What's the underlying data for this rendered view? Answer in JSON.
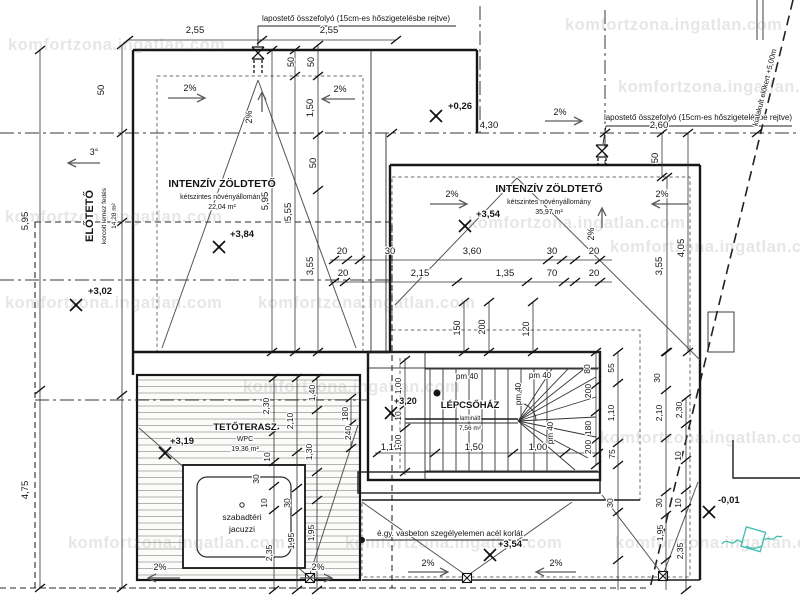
{
  "watermark": {
    "text": "komfortzona.ingatlan.com"
  },
  "icons": {
    "logo": "komfortzona-signature-logo",
    "elevation_marker": "x-cross-benchmark",
    "roof_drain": "funnel-hourglass",
    "floor_drain": "square-with-diagonals"
  },
  "colors": {
    "line": "#1c1c1c",
    "paper": "#ffffff",
    "plants": "#8f8f8f",
    "logo_teal": "#3fbdb0"
  },
  "labels": [
    {
      "n": "note-flat-roof-drain-top",
      "t": "lapostető összefolyó (15cm-es hőszigetelésbe rejtve)",
      "x": 356,
      "y": 21,
      "s": 8,
      "a": "m"
    },
    {
      "n": "note-flat-roof-drain-right",
      "t": "lapostető összefolyó (15cm-es hőszigetelésbe rejtve)",
      "x": 698,
      "y": 120,
      "s": 8,
      "a": "m"
    },
    {
      "n": "note-boundary-setback",
      "t": "kialakult előkert +5,00m",
      "x": 767,
      "y": 88,
      "s": 7.5,
      "a": "m",
      "r": -76
    },
    {
      "n": "note-steel-railing",
      "t": "é.gy. vasbeton szegélyelemen acél korlát",
      "x": 450,
      "y": 536,
      "s": 8,
      "a": "m"
    },
    {
      "n": "room-eloteto-name",
      "t": "ELŐTETŐ",
      "x": 93,
      "y": 216,
      "s": 11,
      "w": 1,
      "a": "m",
      "r": -90
    },
    {
      "n": "room-eloteto-material",
      "t": "korcolt lemez fedés",
      "x": 106,
      "y": 216,
      "s": 6.5,
      "a": "m",
      "r": -90
    },
    {
      "n": "room-eloteto-area",
      "t": "14,28 m²",
      "x": 116,
      "y": 216,
      "s": 6.5,
      "a": "m",
      "r": -90
    },
    {
      "n": "elevation-eloteto",
      "t": "+3,02",
      "x": 88,
      "y": 294,
      "s": 9.5,
      "w": 1,
      "a": "s"
    },
    {
      "n": "room-greenroof-left-name",
      "t": "INTENZÍV ZÖLDTETŐ",
      "x": 222,
      "y": 187,
      "s": 10.5,
      "w": 1,
      "a": "m"
    },
    {
      "n": "room-greenroof-left-material",
      "t": "kétszintes növényállomány",
      "x": 222,
      "y": 199,
      "s": 7,
      "a": "m"
    },
    {
      "n": "room-greenroof-left-area",
      "t": "22,04 m²",
      "x": 222,
      "y": 209,
      "s": 7,
      "a": "m"
    },
    {
      "n": "elevation-greenroof-left",
      "t": "+3,84",
      "x": 230,
      "y": 237,
      "s": 9.5,
      "w": 1,
      "a": "s"
    },
    {
      "n": "room-greenroof-right-name",
      "t": "INTENZÍV ZÖLDTETŐ",
      "x": 549,
      "y": 192,
      "s": 10.5,
      "w": 1,
      "a": "m"
    },
    {
      "n": "room-greenroof-right-material",
      "t": "kétszintes növényállomány",
      "x": 549,
      "y": 204,
      "s": 7,
      "a": "m"
    },
    {
      "n": "room-greenroof-right-area",
      "t": "35,97 m²",
      "x": 549,
      "y": 214,
      "s": 7,
      "a": "m"
    },
    {
      "n": "elevation-greenroof-right",
      "t": "+3,54",
      "x": 476,
      "y": 217,
      "s": 9.5,
      "w": 1,
      "a": "s"
    },
    {
      "n": "elevation-plus026",
      "t": "+0,26",
      "x": 448,
      "y": 109,
      "s": 9.5,
      "w": 1,
      "a": "s"
    },
    {
      "n": "room-staircase-name",
      "t": "LÉPCSŐHÁZ",
      "x": 470,
      "y": 408,
      "s": 9.5,
      "w": 1,
      "a": "m"
    },
    {
      "n": "room-staircase-material",
      "t": "laminált",
      "x": 470,
      "y": 420,
      "s": 6,
      "a": "m"
    },
    {
      "n": "room-staircase-area",
      "t": "7,56 m²",
      "x": 470,
      "y": 430,
      "s": 6.5,
      "a": "m"
    },
    {
      "n": "elevation-staircase",
      "t": "+3,20",
      "x": 394,
      "y": 404,
      "s": 9,
      "w": 1,
      "a": "s"
    },
    {
      "n": "room-terrace-name",
      "t": "TETŐTERASZ",
      "x": 245,
      "y": 430,
      "s": 9.5,
      "w": 1,
      "a": "m"
    },
    {
      "n": "room-terrace-material",
      "t": "WPC",
      "x": 245,
      "y": 441,
      "s": 7,
      "a": "m"
    },
    {
      "n": "room-terrace-area",
      "t": "19,36 m²",
      "x": 245,
      "y": 451,
      "s": 7,
      "a": "m"
    },
    {
      "n": "elevation-terrace",
      "t": "+3,19",
      "x": 170,
      "y": 444,
      "s": 9.5,
      "w": 1,
      "a": "s"
    },
    {
      "n": "label-jacuzzi-line1",
      "t": "szabadtéri",
      "x": 242,
      "y": 520,
      "s": 8.5,
      "a": "m"
    },
    {
      "n": "label-jacuzzi-line2",
      "t": "jacuzzi",
      "x": 242,
      "y": 532,
      "s": 8.5,
      "a": "m"
    },
    {
      "n": "elevation-greenroof-bottom",
      "t": "+3,54",
      "x": 498,
      "y": 547,
      "s": 9.5,
      "w": 1,
      "a": "s"
    },
    {
      "n": "elevation-minus001",
      "t": "-0,01",
      "x": 718,
      "y": 503,
      "s": 9.5,
      "w": 1,
      "a": "s"
    },
    {
      "n": "slope-left-1",
      "t": "2%",
      "x": 190,
      "y": 91,
      "s": 9,
      "a": "m"
    },
    {
      "n": "slope-left-2",
      "t": "2%",
      "x": 340,
      "y": 92,
      "s": 9,
      "a": "m"
    },
    {
      "n": "slope-left-3",
      "t": "2%",
      "x": 252,
      "y": 117,
      "s": 9,
      "a": "m",
      "r": -90
    },
    {
      "n": "slope-right-1",
      "t": "2%",
      "x": 560,
      "y": 115,
      "s": 9,
      "a": "m"
    },
    {
      "n": "slope-right-2",
      "t": "2%",
      "x": 452,
      "y": 197,
      "s": 9,
      "a": "m"
    },
    {
      "n": "slope-right-3",
      "t": "2%",
      "x": 662,
      "y": 197,
      "s": 9,
      "a": "m"
    },
    {
      "n": "slope-right-4",
      "t": "2%",
      "x": 594,
      "y": 234,
      "s": 9,
      "a": "m",
      "r": -90
    },
    {
      "n": "slope-bottom-1",
      "t": "2%",
      "x": 428,
      "y": 566,
      "s": 9,
      "a": "m"
    },
    {
      "n": "slope-bottom-2",
      "t": "2%",
      "x": 556,
      "y": 566,
      "s": 9,
      "a": "m"
    },
    {
      "n": "slope-terrace-1",
      "t": "2%",
      "x": 160,
      "y": 570,
      "s": 9,
      "a": "m"
    },
    {
      "n": "slope-terrace-2",
      "t": "2%",
      "x": 318,
      "y": 570,
      "s": 9,
      "a": "m"
    },
    {
      "n": "slope-eloteto",
      "t": "3°",
      "x": 94,
      "y": 155,
      "s": 9,
      "a": "m"
    },
    {
      "n": "dim",
      "t": "2,55",
      "x": 195,
      "y": 33,
      "s": 9.5,
      "a": "m"
    },
    {
      "n": "dim",
      "t": "2,55",
      "x": 329,
      "y": 33,
      "s": 9.5,
      "a": "m"
    },
    {
      "n": "dim",
      "t": "4,30",
      "x": 489,
      "y": 128,
      "s": 9.5,
      "a": "m"
    },
    {
      "n": "dim",
      "t": "2,60",
      "x": 659,
      "y": 128,
      "s": 9.5,
      "a": "m"
    },
    {
      "n": "dim",
      "t": "20",
      "x": 342,
      "y": 254,
      "s": 9.5,
      "a": "m"
    },
    {
      "n": "dim",
      "t": "30",
      "x": 390,
      "y": 254,
      "s": 9.5,
      "a": "m"
    },
    {
      "n": "dim",
      "t": "3,60",
      "x": 472,
      "y": 254,
      "s": 9.5,
      "a": "m"
    },
    {
      "n": "dim",
      "t": "30",
      "x": 552,
      "y": 254,
      "s": 9.5,
      "a": "m"
    },
    {
      "n": "dim",
      "t": "20",
      "x": 594,
      "y": 254,
      "s": 9.5,
      "a": "m"
    },
    {
      "n": "dim",
      "t": "20",
      "x": 343,
      "y": 276,
      "s": 9.5,
      "a": "m"
    },
    {
      "n": "dim",
      "t": "2,15",
      "x": 420,
      "y": 276,
      "s": 9.5,
      "a": "m"
    },
    {
      "n": "dim",
      "t": "1,35",
      "x": 505,
      "y": 276,
      "s": 9.5,
      "a": "m"
    },
    {
      "n": "dim",
      "t": "70",
      "x": 552,
      "y": 276,
      "s": 9.5,
      "a": "m"
    },
    {
      "n": "dim",
      "t": "20",
      "x": 594,
      "y": 276,
      "s": 9.5,
      "a": "m"
    },
    {
      "n": "dim",
      "t": "1,10",
      "x": 390,
      "y": 450,
      "s": 9.5,
      "a": "m"
    },
    {
      "n": "dim",
      "t": "1,50",
      "x": 474,
      "y": 450,
      "s": 9.5,
      "a": "m"
    },
    {
      "n": "dim",
      "t": "1,00",
      "x": 538,
      "y": 450,
      "s": 9.5,
      "a": "m"
    },
    {
      "n": "dim",
      "t": "50",
      "x": 104,
      "y": 90,
      "s": 9.5,
      "a": "m",
      "r": -90
    },
    {
      "n": "dim",
      "t": "5,95",
      "x": 28,
      "y": 221,
      "s": 9.5,
      "a": "m",
      "r": -90
    },
    {
      "n": "dim",
      "t": "4,75",
      "x": 28,
      "y": 490,
      "s": 9.5,
      "a": "m",
      "r": -90
    },
    {
      "n": "dim",
      "t": "5,95",
      "x": 268,
      "y": 201,
      "s": 9.5,
      "a": "m",
      "r": -90
    },
    {
      "n": "dim",
      "t": "5,55",
      "x": 291,
      "y": 212,
      "s": 9.5,
      "a": "m",
      "r": -90
    },
    {
      "n": "dim",
      "t": "1,50",
      "x": 313,
      "y": 108,
      "s": 9.5,
      "a": "m",
      "r": -90
    },
    {
      "n": "dim",
      "t": "50",
      "x": 316,
      "y": 163,
      "s": 9.5,
      "a": "m",
      "r": -90
    },
    {
      "n": "dim",
      "t": "3,55",
      "x": 313,
      "y": 266,
      "s": 9.5,
      "a": "m",
      "r": -90
    },
    {
      "n": "dim",
      "t": "50",
      "x": 294,
      "y": 62,
      "s": 9,
      "a": "m",
      "r": -90
    },
    {
      "n": "dim",
      "t": "50",
      "x": 314,
      "y": 62,
      "s": 9,
      "a": "m",
      "r": -90
    },
    {
      "n": "dim",
      "t": "50",
      "x": 658,
      "y": 158,
      "s": 9.5,
      "a": "m",
      "r": -90
    },
    {
      "n": "dim",
      "t": "3,55",
      "x": 662,
      "y": 266,
      "s": 9.5,
      "a": "m",
      "r": -90
    },
    {
      "n": "dim",
      "t": "4,05",
      "x": 684,
      "y": 248,
      "s": 9.5,
      "a": "m",
      "r": -90
    },
    {
      "n": "dim",
      "t": "150",
      "x": 460,
      "y": 328,
      "s": 9,
      "a": "m",
      "r": -90
    },
    {
      "n": "dim",
      "t": "200",
      "x": 485,
      "y": 327,
      "s": 9,
      "a": "m",
      "r": -90
    },
    {
      "n": "dim",
      "t": "120",
      "x": 529,
      "y": 329,
      "s": 9,
      "a": "m",
      "r": -90
    },
    {
      "n": "dim",
      "t": "1,00",
      "x": 401,
      "y": 386,
      "s": 8.5,
      "a": "m",
      "r": -90
    },
    {
      "n": "dim",
      "t": "10",
      "x": 401,
      "y": 416,
      "s": 8.5,
      "a": "m",
      "r": -90
    },
    {
      "n": "dim",
      "t": "1,00",
      "x": 401,
      "y": 443,
      "s": 8.5,
      "a": "m",
      "r": -90
    },
    {
      "n": "parapet-mark",
      "t": "pm 40",
      "x": 467,
      "y": 379,
      "s": 8,
      "a": "m"
    },
    {
      "n": "parapet-mark",
      "t": "pm 40",
      "x": 540,
      "y": 378,
      "s": 8,
      "a": "m"
    },
    {
      "n": "parapet-mark",
      "t": "pm 40",
      "x": 521,
      "y": 394,
      "s": 8,
      "a": "m",
      "r": -90
    },
    {
      "n": "parapet-mark",
      "t": "pm 40",
      "x": 553,
      "y": 433,
      "s": 8,
      "a": "m",
      "r": -90
    },
    {
      "n": "dim",
      "t": "80",
      "x": 590,
      "y": 369,
      "s": 8.5,
      "a": "m",
      "r": -90
    },
    {
      "n": "dim",
      "t": "55",
      "x": 614,
      "y": 368,
      "s": 8.5,
      "a": "m",
      "r": -90
    },
    {
      "n": "dim",
      "t": "200",
      "x": 591,
      "y": 391,
      "s": 8.5,
      "a": "m",
      "r": -90
    },
    {
      "n": "dim",
      "t": "1,10",
      "x": 614,
      "y": 413,
      "s": 8.5,
      "a": "m",
      "r": -90
    },
    {
      "n": "dim",
      "t": "30",
      "x": 660,
      "y": 378,
      "s": 8.5,
      "a": "m",
      "r": -90
    },
    {
      "n": "dim",
      "t": "180",
      "x": 591,
      "y": 428,
      "s": 8.5,
      "a": "m",
      "r": -90
    },
    {
      "n": "dim",
      "t": "2,10",
      "x": 662,
      "y": 413,
      "s": 8.5,
      "a": "m",
      "r": -90
    },
    {
      "n": "dim",
      "t": "200",
      "x": 591,
      "y": 447,
      "s": 8.5,
      "a": "m",
      "r": -90
    },
    {
      "n": "dim",
      "t": "2,30",
      "x": 682,
      "y": 410,
      "s": 8.5,
      "a": "m",
      "r": -90
    },
    {
      "n": "dim",
      "t": "75",
      "x": 615,
      "y": 454,
      "s": 8.5,
      "a": "m",
      "r": -90
    },
    {
      "n": "dim",
      "t": "30",
      "x": 613,
      "y": 503,
      "s": 8.5,
      "a": "m",
      "r": -90
    },
    {
      "n": "dim",
      "t": "10",
      "x": 681,
      "y": 456,
      "s": 8.5,
      "a": "m",
      "r": -90
    },
    {
      "n": "dim",
      "t": "30",
      "x": 662,
      "y": 503,
      "s": 8.5,
      "a": "m",
      "r": -90
    },
    {
      "n": "dim",
      "t": "10",
      "x": 681,
      "y": 503,
      "s": 8.5,
      "a": "m",
      "r": -90
    },
    {
      "n": "dim",
      "t": "1,95",
      "x": 663,
      "y": 533,
      "s": 8.5,
      "a": "m",
      "r": -90
    },
    {
      "n": "dim",
      "t": "2,35",
      "x": 683,
      "y": 551,
      "s": 8.5,
      "a": "m",
      "r": -90
    },
    {
      "n": "dim",
      "t": "2,30",
      "x": 269,
      "y": 406,
      "s": 8.5,
      "a": "m",
      "r": -90
    },
    {
      "n": "dim",
      "t": "2,10",
      "x": 293,
      "y": 421,
      "s": 8.5,
      "a": "m",
      "r": -90
    },
    {
      "n": "dim",
      "t": "1,40",
      "x": 315,
      "y": 393,
      "s": 8.5,
      "a": "m",
      "r": -90
    },
    {
      "n": "dim",
      "t": "1,30",
      "x": 312,
      "y": 452,
      "s": 8.5,
      "a": "m",
      "r": -90
    },
    {
      "n": "dim",
      "t": "10",
      "x": 270,
      "y": 457,
      "s": 8.5,
      "a": "m",
      "r": -90
    },
    {
      "n": "dim",
      "t": "30",
      "x": 259,
      "y": 479,
      "s": 8.5,
      "a": "m",
      "r": -90
    },
    {
      "n": "dim",
      "t": "10",
      "x": 267,
      "y": 503,
      "s": 8.5,
      "a": "m",
      "r": -90
    },
    {
      "n": "dim",
      "t": "30",
      "x": 290,
      "y": 503,
      "s": 8.5,
      "a": "m",
      "r": -90
    },
    {
      "n": "dim",
      "t": "2,35",
      "x": 272,
      "y": 553,
      "s": 8.5,
      "a": "m",
      "r": -90
    },
    {
      "n": "dim",
      "t": "1,95",
      "x": 294,
      "y": 541,
      "s": 8.5,
      "a": "m",
      "r": -90
    },
    {
      "n": "dim",
      "t": "1,95",
      "x": 314,
      "y": 533,
      "s": 8.5,
      "a": "m",
      "r": -90
    },
    {
      "n": "dim",
      "t": "180",
      "x": 348,
      "y": 414,
      "s": 8.5,
      "a": "m",
      "r": -90
    },
    {
      "n": "dim",
      "t": "240",
      "x": 351,
      "y": 433,
      "s": 8.5,
      "a": "m",
      "r": -90
    }
  ]
}
